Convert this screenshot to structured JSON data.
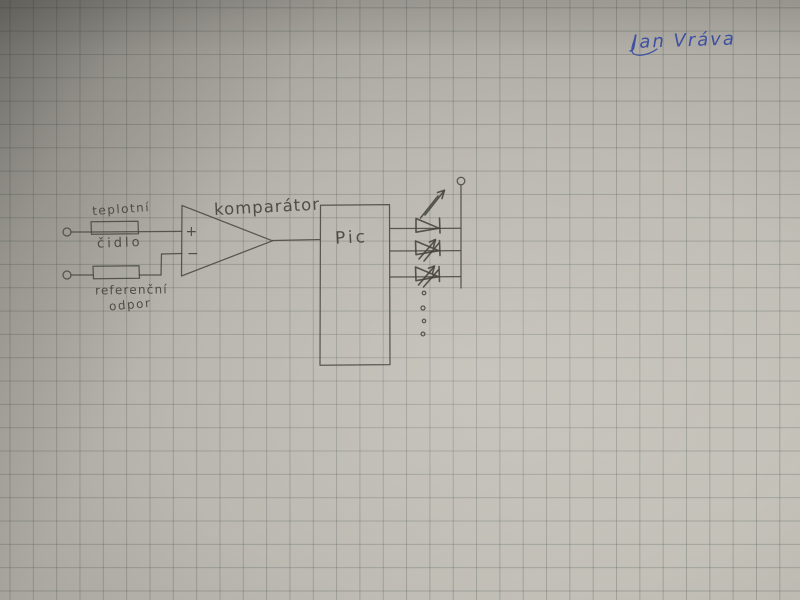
{
  "photo": {
    "kind": "photograph of a hand-drawn circuit schematic in pencil on gray squared graph paper",
    "paper_color": "#b9b6af",
    "grid_color": "#848b84",
    "pencil_color": "#4a4942",
    "ink_color": "#3d4fa3"
  },
  "signature": {
    "text": "Jan Vráva"
  },
  "schematic": {
    "labels": {
      "sensor_line1": "teplotní",
      "sensor_line2": "čidlo",
      "reference_line1": "referenční",
      "reference_line2": "odpor",
      "comparator": "komparátor",
      "plus_input": "+",
      "minus_input": "−",
      "chip": "Pic"
    },
    "components": [
      {
        "id": "temperature-sensor",
        "label": "teplotní čidlo",
        "type": "resistor"
      },
      {
        "id": "reference-resistor",
        "label": "referenční odpor",
        "type": "resistor"
      },
      {
        "id": "comparator",
        "label": "komparátor",
        "type": "op-amp comparator symbol"
      },
      {
        "id": "microcontroller",
        "label": "Pic",
        "type": "IC block"
      },
      {
        "id": "led-array",
        "type": "3 LED symbols with ellipsis dots, tied to supply rail terminal"
      }
    ]
  }
}
